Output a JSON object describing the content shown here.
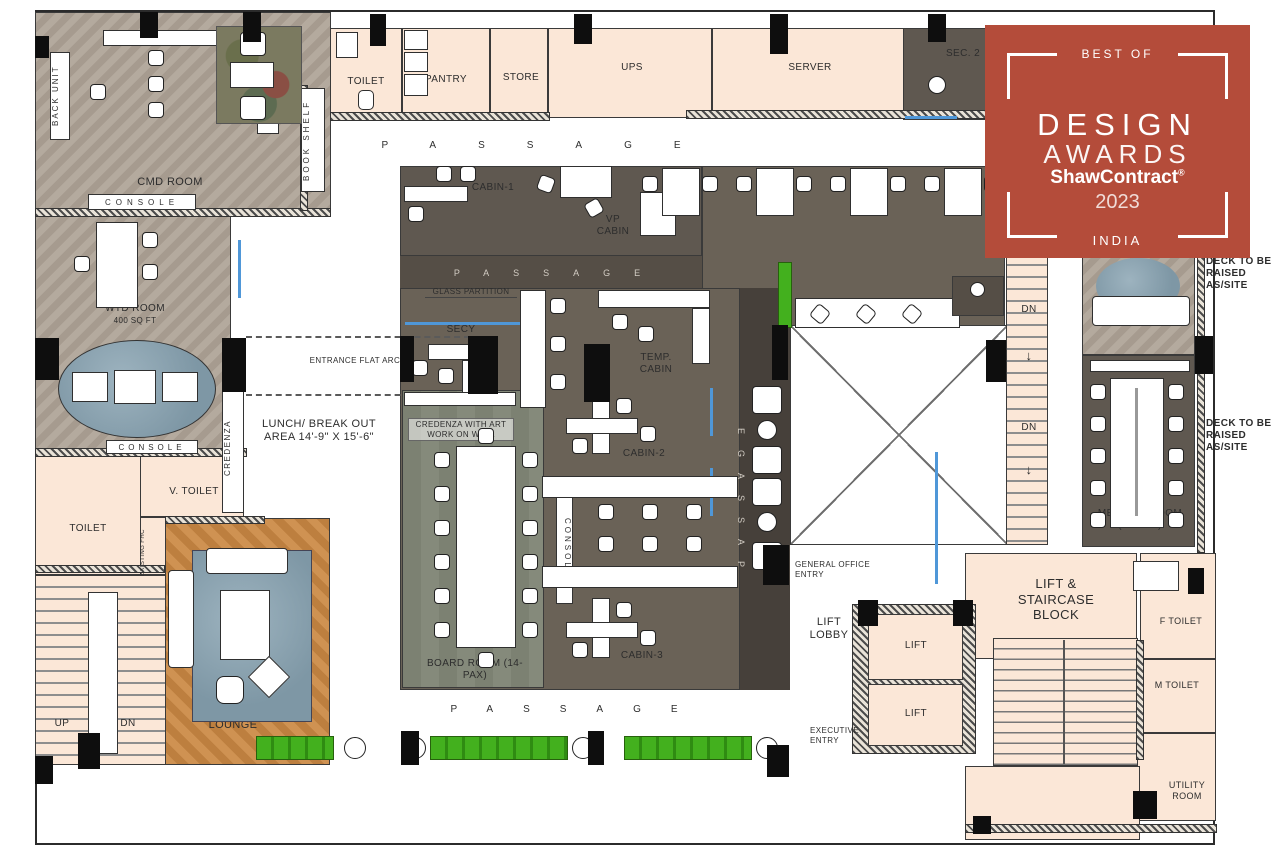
{
  "badge": {
    "best_of": "BEST OF",
    "title1": "DESIGN",
    "title2": "AWARDS",
    "brand": "ShawContract",
    "reg": "®",
    "year": "2023",
    "country": "INDIA",
    "color": "#b44c3a"
  },
  "labels": {
    "back_unit": "BACK UNIT",
    "cmd_room": "CMD ROOM",
    "console": "CONSOLE",
    "book_shelf": "BOOK SHELF",
    "toilet": "TOILET",
    "pantry": "PANTRY",
    "store": "STORE",
    "ups": "UPS",
    "server": "SERVER",
    "sec2": "SEC. 2",
    "passage": "PASSAGE",
    "cabin1": "CABIN-1",
    "vp_cabin": "VP CABIN",
    "glass_partition": "GLASS PARTITION",
    "secy": "SECY",
    "temp_cabin": "TEMP. CABIN",
    "wtd_room": "WTD ROOM",
    "wtd_area": "400 SQ FT",
    "entrance_arch": "ENTRANCE FLAT ARCH",
    "credenza": "CREDENZA",
    "lunch_area": "LUNCH/ BREAK OUT AREA 14'-9\" X 15'-6\"",
    "credenza_art": "CREDENZA WITH ART WORK ON WALL",
    "cabin2": "CABIN-2",
    "cabin3": "CABIN-3",
    "v_toilet": "V. TOILET",
    "existing_fhc": "EXISTING FHC",
    "board_room": "BOARD ROOM (14-PAX)",
    "exec_lounge": "EXECUTIVE LOUNGE",
    "up": "UP",
    "dn": "DN",
    "general_entry": "GENERAL OFFICE ENTRY",
    "exec_entry": "EXECUTIVE ENTRY",
    "lift_lobby": "LIFT LOBBY",
    "lift": "LIFT",
    "lift_staircase": "LIFT & STAIRCASE BLOCK",
    "ph_booth": "PH BOOTH",
    "meeting_room": "MEETING ROOM (10-PAX)",
    "deck": "DECK TO BE RAISED AS/SITE",
    "f_toilet": "F TOILET",
    "m_toilet": "M TOILET",
    "utility": "UTILITY ROOM",
    "down_arrow": "↓"
  },
  "colors": {
    "badge_red": "#b44c3a",
    "cream_room": "#fbe7d7",
    "marble_gray": "#c3c3c3",
    "dark_carpet": "#5f5850",
    "glass_blue": "#4f97d8",
    "plant_green": "#43b01e",
    "wood": "#cf9252"
  }
}
